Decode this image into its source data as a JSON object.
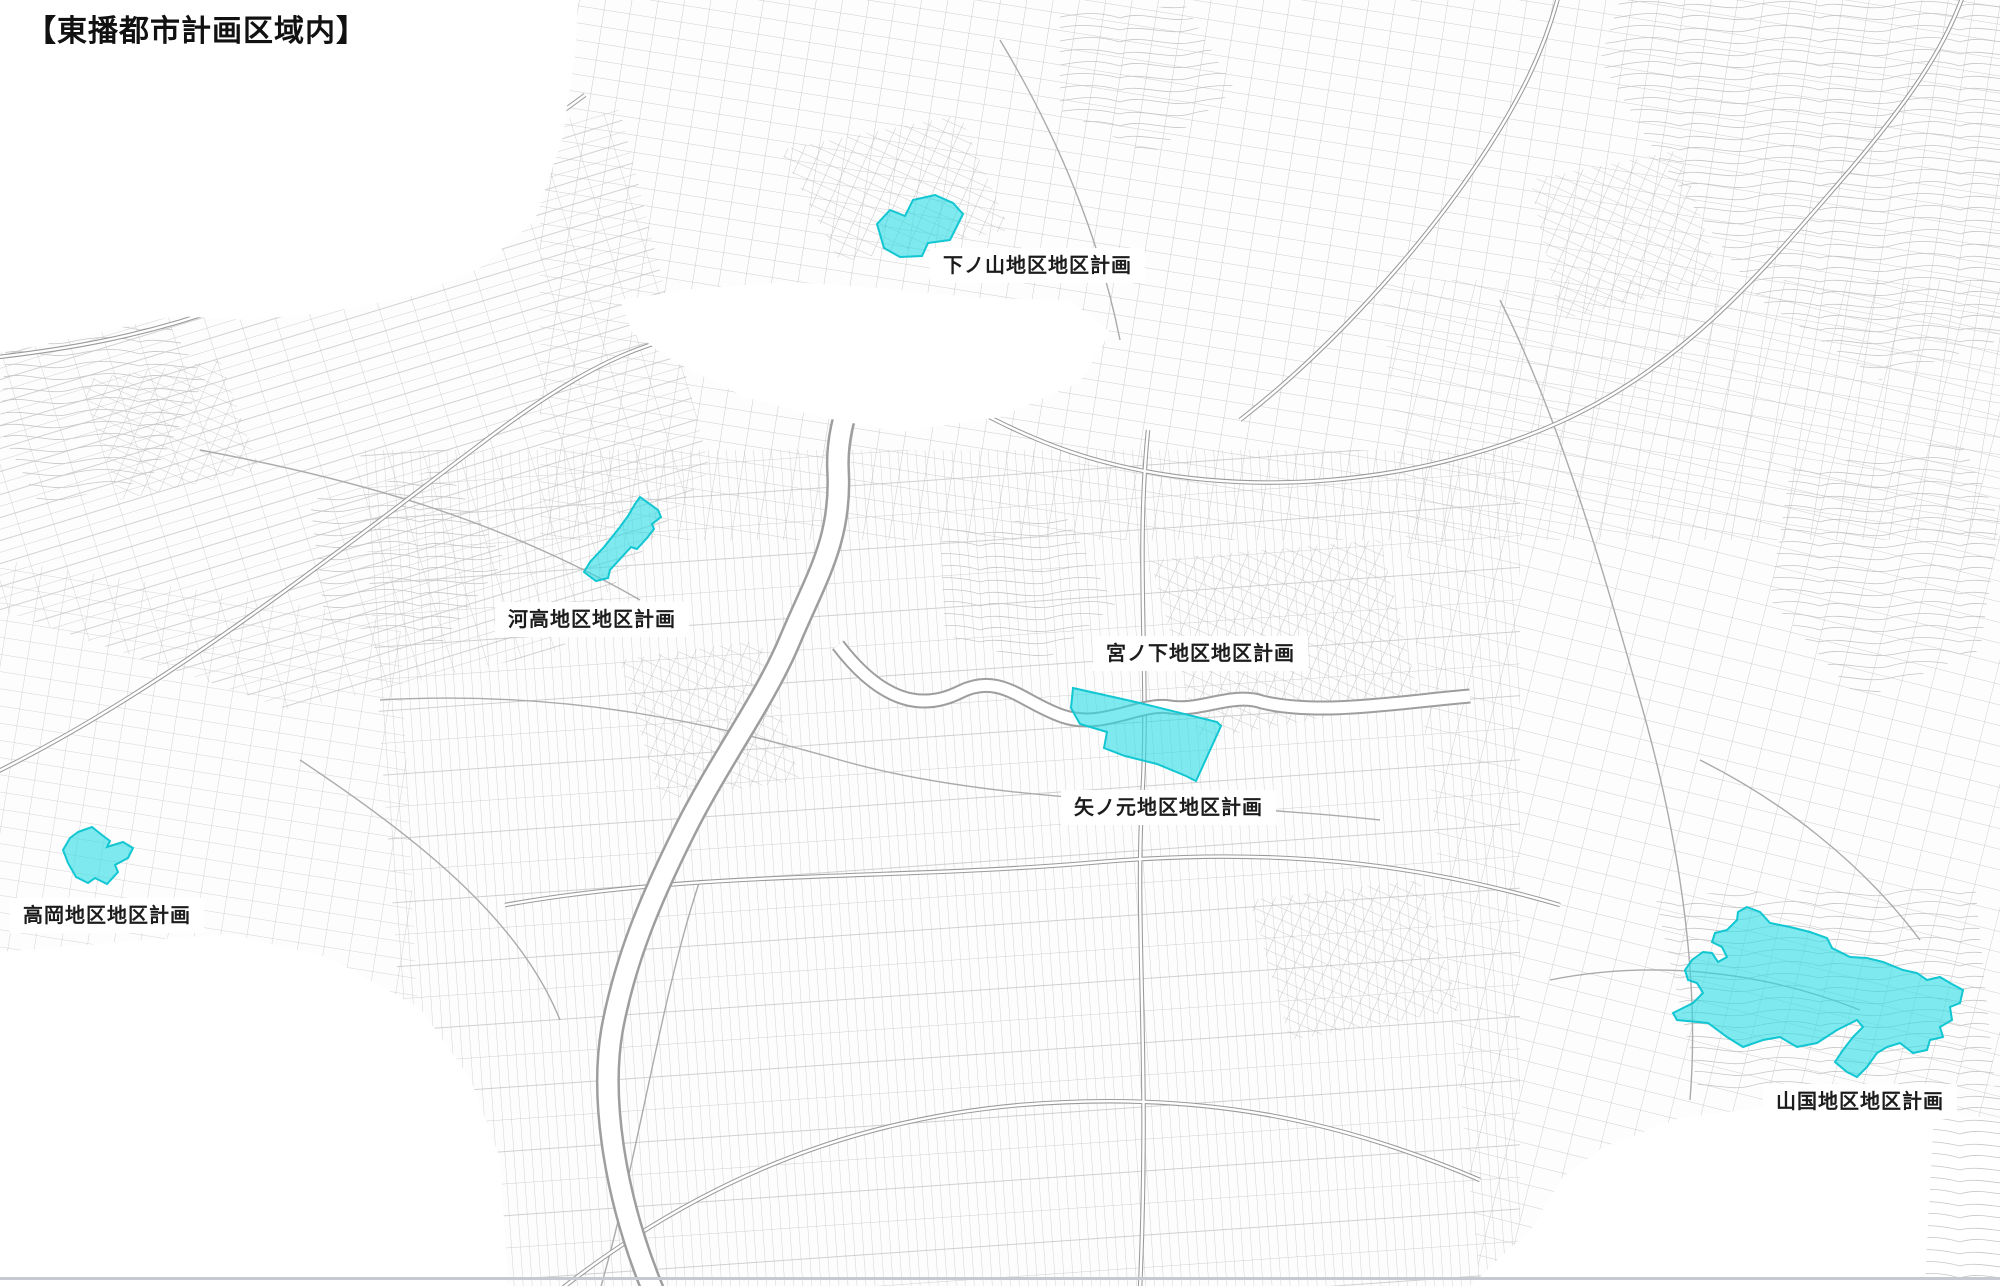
{
  "title": "【東播都市計画区域内】",
  "map": {
    "description_colors": {
      "highlight_fill": "#2adee6",
      "highlight_border": "#12c6d2",
      "base_linework": "#bcbcbc"
    },
    "districts": [
      {
        "id": "shimonoyama",
        "label": "下ノ山地区地区計画"
      },
      {
        "id": "kawataka",
        "label": "河高地区地区計画"
      },
      {
        "id": "miyanoshita",
        "label": "宮ノ下地区地区計画"
      },
      {
        "id": "yanomoto",
        "label": "矢ノ元地区地区計画"
      },
      {
        "id": "takaoka",
        "label": "高岡地区地区計画"
      },
      {
        "id": "yamakuni",
        "label": "山国地区地区計画"
      }
    ]
  }
}
